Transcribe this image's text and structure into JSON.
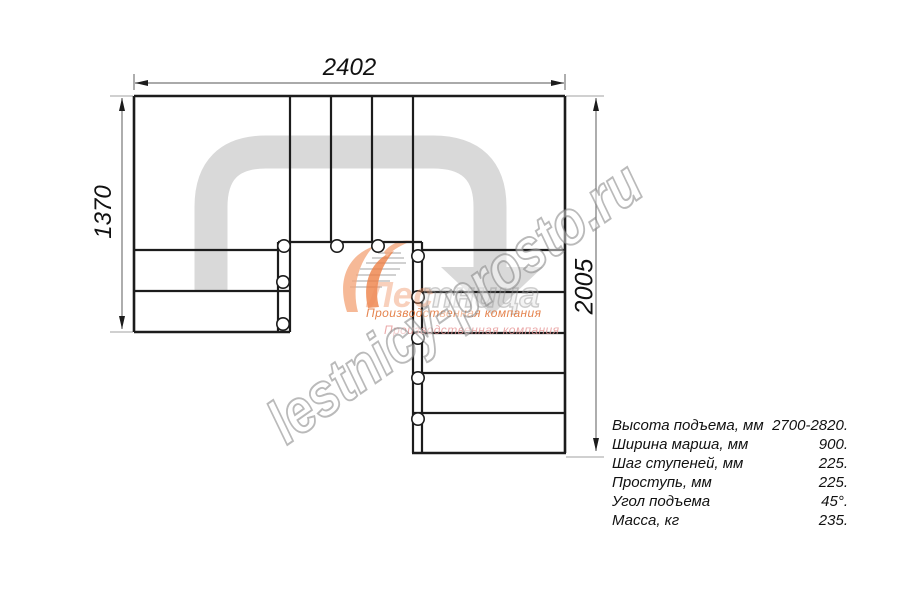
{
  "drawing": {
    "type": "staircase plan, top view",
    "dimensions": {
      "width_top": "2402",
      "height_left": "1370",
      "height_right": "2005"
    },
    "specs": {
      "rows": [
        {
          "label": "Высота подъема, мм",
          "value": "2700-2820."
        },
        {
          "label": "Ширина марша, мм",
          "value": "900."
        },
        {
          "label": "Шаг ступеней, мм",
          "value": "225."
        },
        {
          "label": "Проступь, мм",
          "value": "225."
        },
        {
          "label": "Угол подъема",
          "value": "45°."
        },
        {
          "label": "Масса, кг",
          "value": "235."
        }
      ]
    },
    "watermark": {
      "text": "lestnicy-prosto.ru"
    },
    "logo": {
      "name_primary": "Лес",
      "name_ghost": "тница",
      "tagline": "Производственная компания",
      "tagline_shadow": "Производственная компания"
    },
    "colors": {
      "line": "#1c1c1c",
      "dim_line": "#777777",
      "extension_line": "#b5b5b5",
      "route_arrow": "#d9d9d9",
      "watermark_gray": "#9a9a9a",
      "logo_orange": "#ee8147",
      "logo_orange_light": "#f4a87e",
      "tagline_orange": "#e06e30",
      "tagline_pink": "#e69494"
    }
  }
}
